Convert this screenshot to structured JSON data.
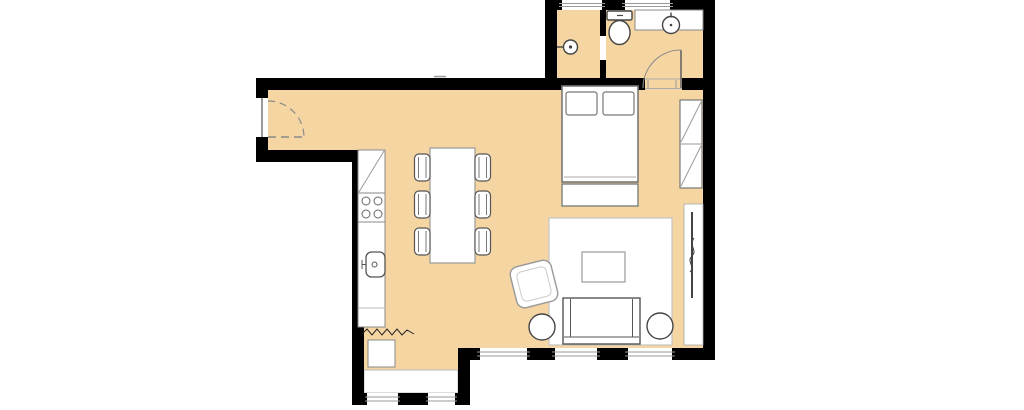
{
  "title": "apartment-floor-plan",
  "colors": {
    "floor": "#F5D6A3",
    "wall": "#000000",
    "fill": "#FFFFFF",
    "line": "#888888",
    "dark": "#444444",
    "win": "#9A9A9A",
    "arc": "#8A8A8A",
    "rug": "#C4C4C4",
    "bg": "#FFFFFF"
  },
  "rooms": [
    {
      "name": "entry-hall"
    },
    {
      "name": "kitchen-dining-area"
    },
    {
      "name": "living-area"
    },
    {
      "name": "sleeping-area"
    },
    {
      "name": "shower-room"
    },
    {
      "name": "wc-bathroom"
    },
    {
      "name": "balcony"
    }
  ],
  "furniture": [
    "entry-door",
    "shower-head",
    "toilet",
    "washbasin-counter",
    "washbasin",
    "bathroom-door",
    "bed",
    "pillow",
    "pillow",
    "bed-bench",
    "wardrobe",
    "tv-unit",
    "tv",
    "rug",
    "coffee-table",
    "sofa",
    "side-table",
    "side-table",
    "armchair",
    "kitchen-cabinet",
    "stove",
    "kitchen-counter",
    "kitchen-sink",
    "washing-machine",
    "dining-table",
    "dining-chair",
    "dining-chair",
    "dining-chair",
    "dining-chair",
    "dining-chair",
    "dining-chair"
  ],
  "windows": {
    "count": 7,
    "locations": [
      "shower-room-top",
      "wc-top",
      "living-south-1",
      "living-south-2",
      "living-south-3",
      "balcony-south-1",
      "balcony-south-2"
    ]
  }
}
